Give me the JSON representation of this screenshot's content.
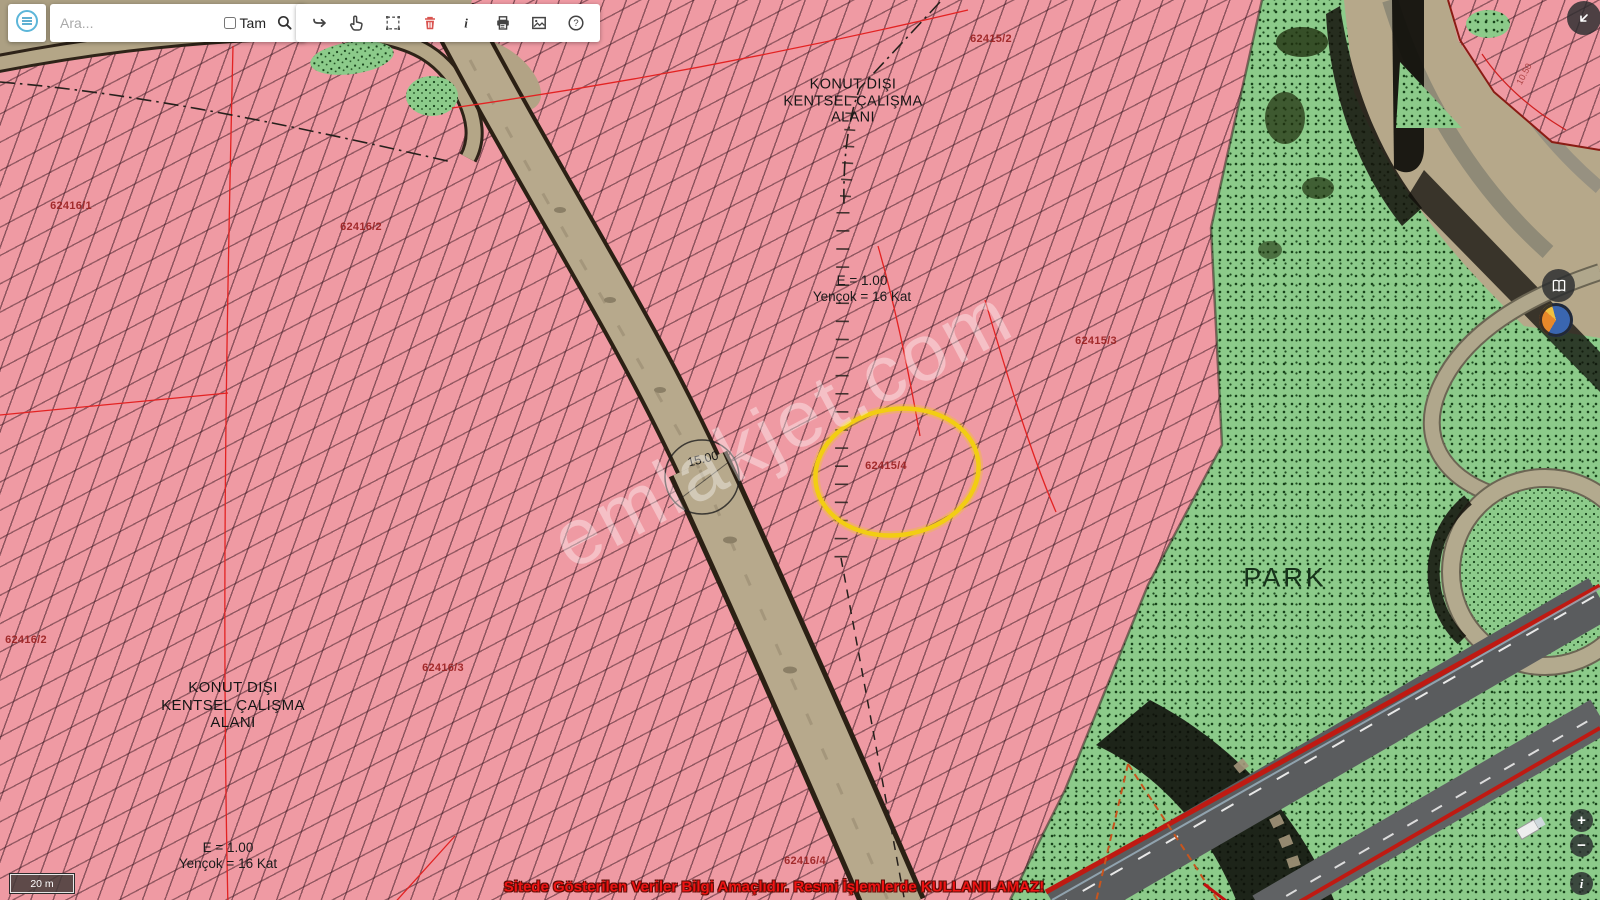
{
  "toolbar": {
    "search_placeholder": "Ara...",
    "exact_label": "Tam"
  },
  "icons": {
    "menu": "hamburger-menu-icon",
    "search": "magnifier-icon",
    "tools": [
      "forward-arrow-icon",
      "hand-pointer-icon",
      "area-select-icon",
      "trash-icon",
      "info-icon",
      "printer-icon",
      "save-image-icon",
      "help-icon"
    ],
    "side": [
      "map-book-icon",
      "earth-icon",
      "back-arrow-icon"
    ]
  },
  "controls": {
    "zoom_in": "+",
    "zoom_out": "−",
    "info": "i"
  },
  "map": {
    "labels": {
      "zone_top": [
        "KONUT DIŞI",
        "KENTSEL ÇALIŞMA",
        "ALANI"
      ],
      "zone_bottom": [
        "KONUT DIŞI",
        "KENTSEL ÇALIŞMA",
        "ALANI"
      ],
      "plan_top": [
        "E = 1.00",
        "Yençok = 16 Kat"
      ],
      "plan_bottom": [
        "E = 1.00",
        "Yençok = 16 Kat"
      ],
      "park": "PARK",
      "road_width": "15.00",
      "road_width_small": "10.50",
      "parcels": [
        "62415/2",
        "62415/3",
        "62415/4",
        "62416/1",
        "62416/2",
        "62416/2",
        "62416/3",
        "62416/4"
      ]
    },
    "watermark": "emlakjet.com",
    "disclaimer": "Sitede Gösterilen Veriler Bilgi Amaçlıdır. Resmi İşlemlerde KULLANILAMAZ!",
    "scale_label": "20 m"
  },
  "colors": {
    "zone_pink": "#ef9aa3",
    "zone_green": "#8ccb8a",
    "highlight_yellow": "#f2cd13",
    "parcel_label_red": "#9c2121",
    "boundary_red": "#e32222",
    "disclaimer_red": "#f01414",
    "road_tan": "#b7a98c"
  }
}
